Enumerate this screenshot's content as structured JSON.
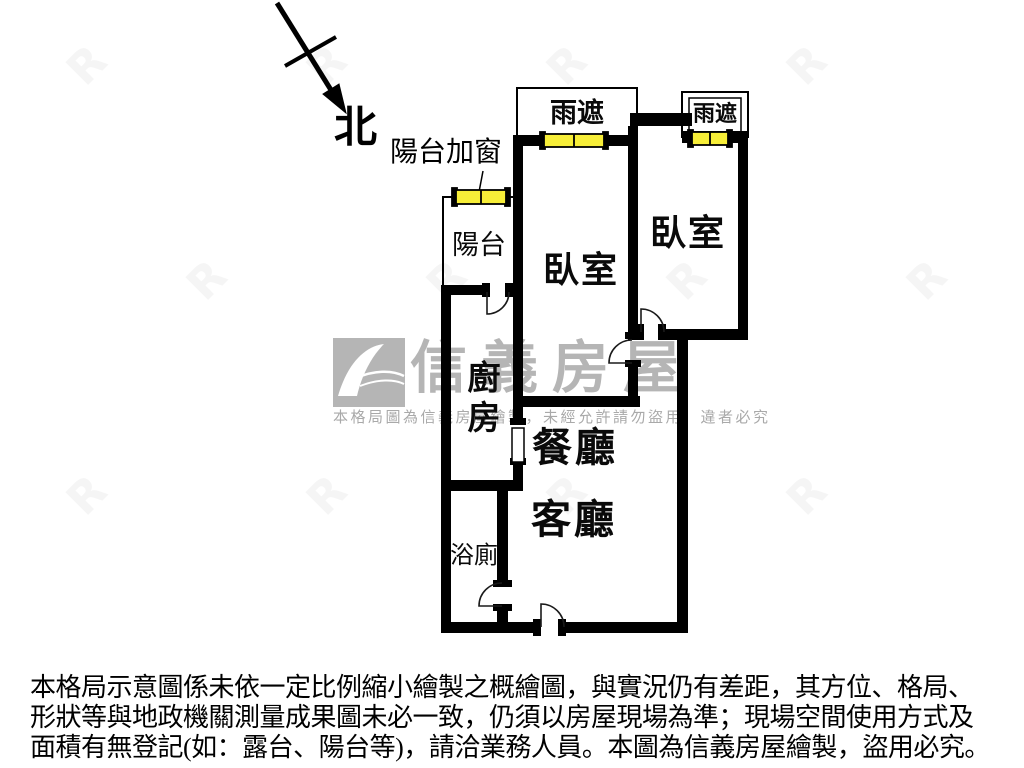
{
  "compass": {
    "label": "北"
  },
  "plan": {
    "balcony_window_note": "陽台加窗",
    "rain_shield_left": "雨遮",
    "rain_shield_right": "雨遮",
    "bedroom_left": "臥室",
    "bedroom_right": "臥室",
    "balcony": "陽台",
    "kitchen": "廚房",
    "dining": "餐廳",
    "living": "客廳",
    "bathroom": "浴廁"
  },
  "watermark": {
    "brand": "信義房屋",
    "notice": "本格局圖為信義房屋繪製，未經允許請勿盜用，違者必究",
    "tile_glyph": "R"
  },
  "disclaimer": {
    "line1": "本格局示意圖係未依一定比例縮小繪製之概繪圖，與實況仍有差距，其方位、格局、",
    "line2": "形狀等與地政機關測量成果圖未必一致，仍須以房屋現場為準；現場空間使用方式及",
    "line3": "面積有無登記(如：露台、陽台等)，請洽業務人員。本圖為信義房屋繪製，盜用必究。"
  },
  "colors": {
    "wall": "#000000",
    "window_fill": "#f7ee38",
    "watermark_gray": "#b5b5b5"
  }
}
